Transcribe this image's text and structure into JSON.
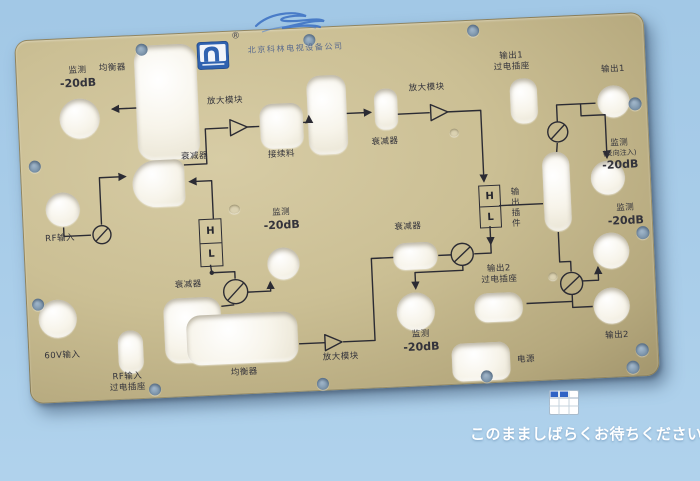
{
  "page": {
    "wait_message": "このまましばらくお待ちください。"
  },
  "icons": {
    "logo": "kelin-arch-logo",
    "placeholder": "table-grid-icon",
    "scribble": "pen-scribble"
  },
  "colors": {
    "background_blue": "#a9cde9",
    "panel_khaki": "#cbbf94",
    "hole_white": "#f7f4ea",
    "screw_blue": "#8098ae",
    "print_line": "#2b2b33",
    "wait_text": "#ffffff",
    "icon_blue": "#2f62c4",
    "company_text": "#5a6b8e"
  },
  "panel": {
    "brand": {
      "company": "北京科林电视设备公司",
      "registered": "®"
    },
    "labels": {
      "monitor_tl_zh": "监测",
      "monitor_tl_db": "-20dB",
      "equalizer_top": "均衡器",
      "attenuator_top": "衰减器",
      "amp_module_top": "放大模块",
      "splice_block": "接续料",
      "attenuator_2": "衰减器",
      "amp_module_2": "放大模块",
      "output1_socket_l1": "输出1",
      "output1_socket_l2": "过电插座",
      "output1": "输出1",
      "monitor_reverse_l1": "监测",
      "monitor_reverse_l2": "(反向注入)",
      "monitor_reverse_l3": "-20dB",
      "monitor_right_zh": "监测",
      "monitor_right_db": "-20dB",
      "output_plugin": "输出插件",
      "monitor_center_zh": "监测",
      "monitor_center_db": "-20dB",
      "attenuator_3": "衰减器",
      "attenuator_4": "衰减器",
      "monitor_low_zh": "监测",
      "monitor_low_db": "-20dB",
      "output2_socket_l1": "输出2",
      "output2_socket_l2": "过电插座",
      "output2": "输出2",
      "power": "电源",
      "amp_module_3": "放大模块",
      "equalizer_low": "均衡器",
      "rf_input": "RF输入",
      "input_60v": "60V输入",
      "rf_socket_l1": "RF输入",
      "rf_socket_l2": "过电插座",
      "h": "H",
      "l": "L"
    }
  }
}
